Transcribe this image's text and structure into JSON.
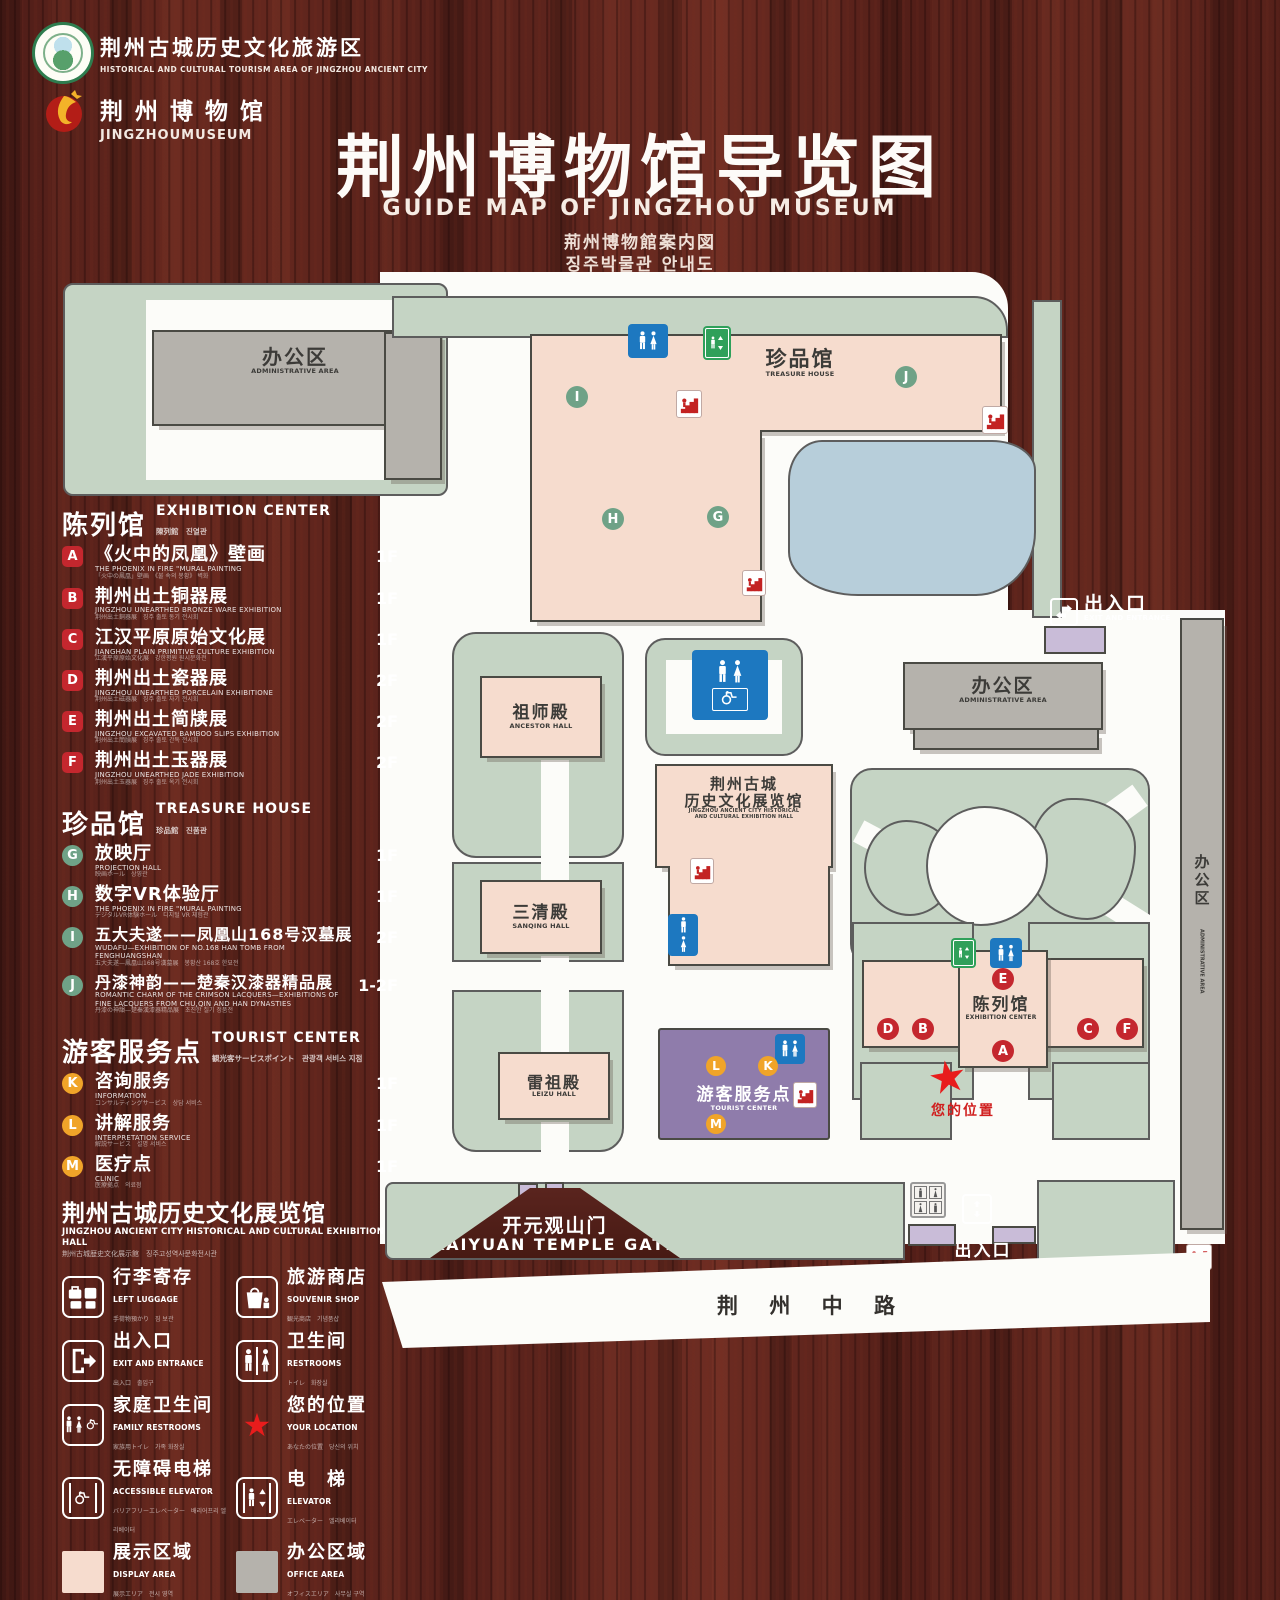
{
  "header": {
    "logo_tourism": {
      "cn": "荆州古城历史文化旅游区",
      "en": "HISTORICAL AND CULTURAL TOURISM AREA OF JINGZHOU ANCIENT CITY"
    },
    "logo_museum": {
      "cn": "荆 州 博 物 馆",
      "en": "JINGZHOUMUSEUM"
    },
    "title_cn": "荆州博物馆导览图",
    "title_en": "GUIDE MAP OF JINGZHOU MUSEUM",
    "title_jp": "荊州博物館案内図",
    "title_kr": "징주박물관 안내도"
  },
  "legend": {
    "sections": [
      {
        "cn": "陈列馆",
        "en": "EXHIBITION CENTER",
        "sub": "陳列館　진열관",
        "items": [
          {
            "letter": "A",
            "cn": "《火中的凤凰》壁画",
            "en": "THE PHOENIX IN FIRE \"MURAL PAINTING",
            "sub": "「火中の鳳凰」壁画　《불 속의 봉황》 벽화",
            "floor": "1F"
          },
          {
            "letter": "B",
            "cn": "荆州出土铜器展",
            "en": "JINGZHOU UNEARTHED BRONZE WARE EXHIBITION",
            "sub": "荆州出土銅器展　징주 출토 동기 전시회",
            "floor": "1F"
          },
          {
            "letter": "C",
            "cn": "江汉平原原始文化展",
            "en": "JIANGHAN PLAIN PRIMITIVE CULTURE EXHIBITION",
            "sub": "江漢平原原始文化展　강한평원 원시문화전",
            "floor": "1F"
          },
          {
            "letter": "D",
            "cn": "荆州出土瓷器展",
            "en": "JINGZHOU UNEARTHED PORCELAIN EXHIBITIONE",
            "sub": "荆州出土磁器展　징주 출토 자기 전시회",
            "floor": "2F"
          },
          {
            "letter": "E",
            "cn": "荆州出土简牍展",
            "en": "JINGZHOU EXCAVATED BAMBOO SLIPS EXHIBITION",
            "sub": "荆州出土簡牘展　징주 출토 간독 전시회",
            "floor": "2F"
          },
          {
            "letter": "F",
            "cn": "荆州出土玉器展",
            "en": "JINGZHOU UNEARTHED JADE EXHIBITION",
            "sub": "荆州出土玉器展　징주 출토 옥기 전시회",
            "floor": "2F"
          }
        ]
      },
      {
        "cn": "珍品馆",
        "en": "TREASURE HOUSE",
        "sub": "珍品館　진품관",
        "items": [
          {
            "letter": "G",
            "cn": "放映厅",
            "en": "PROJECTION HALL",
            "sub": "映画ホール　상영관",
            "floor": "1F"
          },
          {
            "letter": "H",
            "cn": "数字VR体验厅",
            "en": "THE PHOENIX IN FIRE \"MURAL PAINTING",
            "sub": "デジタルVR体験ホール　디지털 VR 체험관",
            "floor": "1F"
          },
          {
            "letter": "I",
            "cn": "五大夫遂——凤凰山168号汉墓展",
            "en": "WUDAFU—EXHIBITION OF NO.168 HAN TOMB FROM FENGHUANGSHAN",
            "sub": "五大夫遂—鳳凰山168号漢墓展　봉황산 168호 한묘전",
            "floor": "2F"
          },
          {
            "letter": "J",
            "cn": "丹漆神韵——楚秦汉漆器精品展",
            "en": "ROMANTIC CHARM OF THE CRIMSON LACQUERS—EXHIBITIONS OF FINE LACQUERS FROM CHU,QIN AND HAN DYNASTIES",
            "sub": "丹漆の神韻—楚秦漢漆器精品展　초진한 칠기 정품전",
            "floor": "1-2F"
          }
        ]
      },
      {
        "cn": "游客服务点",
        "en": "TOURIST CENTER",
        "sub": "観光客サービスポイント　관광객 서비스 지점",
        "items": [
          {
            "letter": "K",
            "cn": "咨询服务",
            "en": "INFORMATION",
            "sub": "コンサルティングサービス　상담 서비스",
            "floor": "1F"
          },
          {
            "letter": "L",
            "cn": "讲解服务",
            "en": "INTERPRETATION SERVICE",
            "sub": "解説サービス　설명 서비스",
            "floor": "1F"
          },
          {
            "letter": "M",
            "cn": "医疗点",
            "en": "CLINIC",
            "sub": "医療拠点　의료점",
            "floor": "1F"
          }
        ]
      }
    ],
    "hall_note": {
      "cn": "荆州古城历史文化展览馆",
      "en": "JINGZHOU ANCIENT CITY HISTORICAL AND CULTURAL EXHIBITION HALL",
      "sub": "荆州古城歴史文化展示館　징주고성역사문화전시관"
    },
    "icons": [
      {
        "name": "left-luggage",
        "cn": "行李寄存",
        "en": "LEFT LUGGAGE",
        "sub": "手荷物預かり　짐 보관"
      },
      {
        "name": "souvenir-shop",
        "cn": "旅游商店",
        "en": "SOUVENIR SHOP",
        "sub": "観光商店　기념품샵"
      },
      {
        "name": "exit-entrance",
        "cn": "出入口",
        "en": "EXIT AND ENTRANCE",
        "sub": "出入口　출입구"
      },
      {
        "name": "restrooms",
        "cn": "卫生间",
        "en": "RESTROOMS",
        "sub": "トイレ　화장실"
      },
      {
        "name": "family-restrooms",
        "cn": "家庭卫生间",
        "en": "FAMILY RESTROOMS",
        "sub": "家族用トイレ　가족 화장실"
      },
      {
        "name": "your-location",
        "cn": "您的位置",
        "en": "YOUR LOCATION",
        "sub": "あなたの位置　당신의 위치"
      },
      {
        "name": "accessible-elevator",
        "cn": "无障碍电梯",
        "en": "ACCESSIBLE ELEVATOR",
        "sub": "バリアフリーエレベーター　배리어프리 엘리베이터"
      },
      {
        "name": "elevator",
        "cn": "电　梯",
        "en": "ELEVATOR",
        "sub": "エレベーター　엘리베이터"
      },
      {
        "name": "display-area",
        "cn": "展示区域",
        "en": "DISPLAY AREA",
        "sub": "展示エリア　전시 영역"
      },
      {
        "name": "office-area",
        "cn": "办公区域",
        "en": "OFFICE AREA",
        "sub": "オフィスエリア　사무실 구역"
      }
    ]
  },
  "map": {
    "labels": {
      "admin_top": {
        "cn": "办公区",
        "en": "ADMINISTRATIVE AREA"
      },
      "treasure_house": {
        "cn": "珍品馆",
        "en": "TREASURE HOUSE"
      },
      "exit_right": {
        "cn": "出入口",
        "en": "EXIT AND ENTRANCE"
      },
      "ancestor_hall": {
        "cn": "祖师殿",
        "en": "ANCESTOR HALL"
      },
      "admin_right": {
        "cn": "办公区",
        "en": "ADMINISTRATIVE AREA"
      },
      "exhibition_hall": {
        "cn1": "荆州古城",
        "cn2": "历史文化展览馆",
        "en1": "JINGZHOU ANCIENT CITY HISTORICAL",
        "en2": "AND CULTURAL EXHIBITION HALL"
      },
      "sanqing_hall": {
        "cn": "三清殿",
        "en": "SANQING HALL"
      },
      "leizu_hall": {
        "cn": "雷祖殿",
        "en": "LEIZU HALL"
      },
      "tourist_center": {
        "cn": "游客服务点",
        "en": "TOURIST CENTER"
      },
      "exhibition_center": {
        "cn": "陈列馆",
        "en": "EXHIBITION CENTER"
      },
      "your_location": {
        "cn": "您的位置"
      },
      "kaiyuan_gate": {
        "cn": "开元观山门",
        "en": "KAIYUAN TEMPLE GATE"
      },
      "exit_bottom": {
        "cn": "出入口",
        "en": "EXIT AND ENTRANCE"
      },
      "road": {
        "cn": "荆 州 中 路"
      },
      "admin_strip": {
        "cn": "办公区",
        "en": "ADMINISTRATIVE AREA"
      }
    },
    "badges": {
      "green": [
        "I",
        "H",
        "G",
        "J"
      ],
      "red": [
        "E",
        "D",
        "B",
        "A",
        "C",
        "F"
      ],
      "orange": [
        "L",
        "K",
        "M"
      ]
    },
    "colors": {
      "display_area": "#f6dcce",
      "office_area": "#b5b2ac",
      "tourist_center": "#8f7cab",
      "gate": "#c9bcd8",
      "lawn": "#c5d4c4",
      "pond": "#b7ceda",
      "restroom_sign": "#1d78c0",
      "elevator_sign": "#2fa05a",
      "badge_red": "#c4272e",
      "badge_green": "#6fa287",
      "badge_orange": "#f0a429",
      "location_star": "#e81c1c",
      "wood": "#571f1a"
    }
  }
}
